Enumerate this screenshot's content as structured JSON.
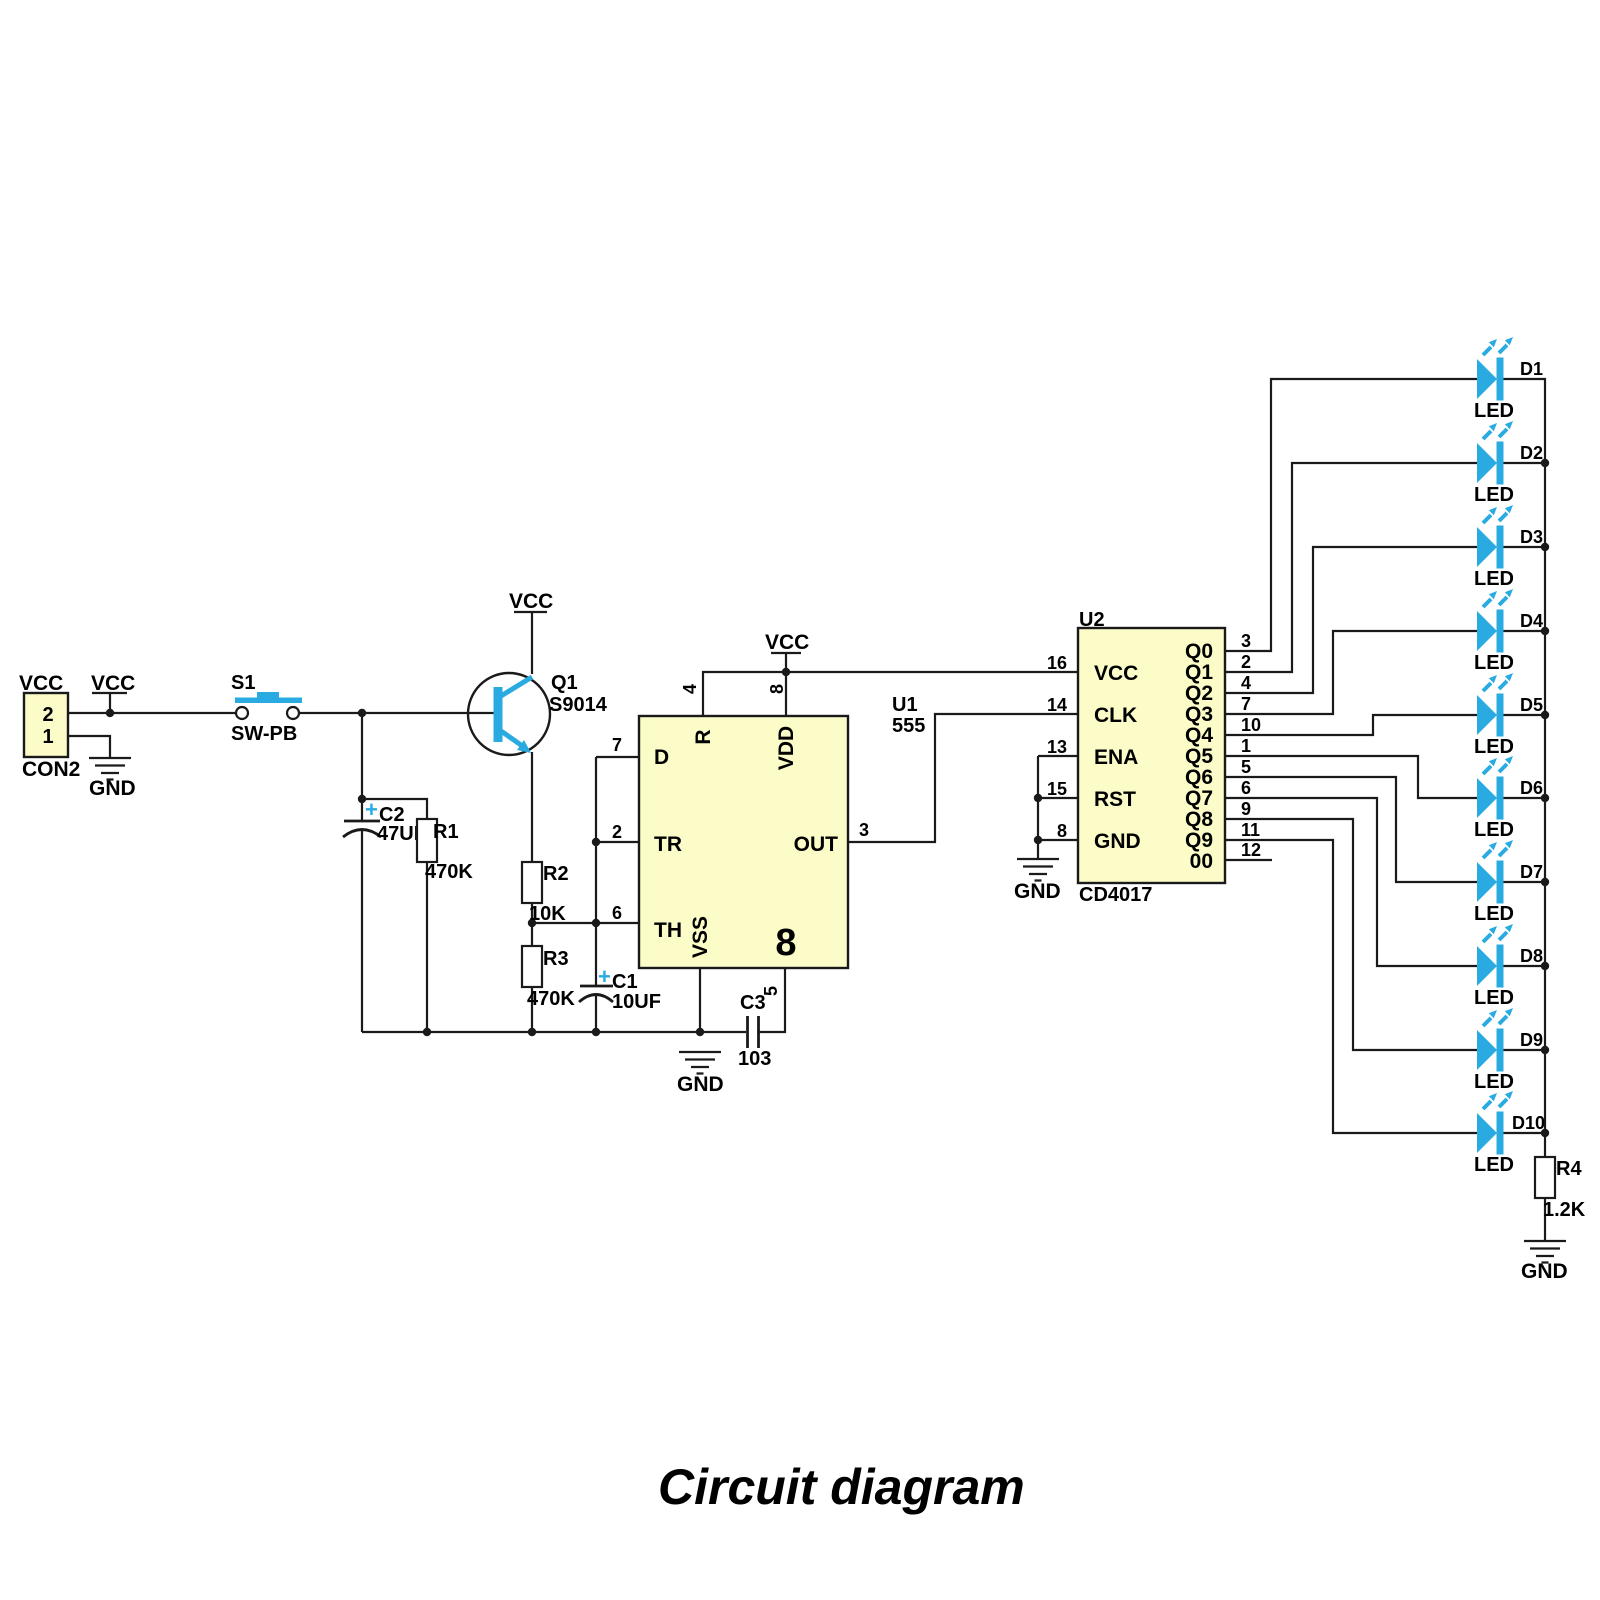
{
  "title": "Circuit diagram",
  "colors": {
    "accent": "#29ABE2",
    "ic_fill": "#FCFCC9",
    "wire": "#1A1A1A"
  },
  "power": {
    "vcc": "VCC",
    "gnd": "GND"
  },
  "con2": {
    "ref": "CON2",
    "pin_top": "2",
    "pin_bottom": "1"
  },
  "s1": {
    "ref": "S1",
    "part": "SW-PB"
  },
  "q1": {
    "ref": "Q1",
    "part": "S9014"
  },
  "r1": {
    "ref": "R1",
    "value": "470K"
  },
  "r2": {
    "ref": "R2",
    "value": "10K"
  },
  "r3": {
    "ref": "R3",
    "value": "470K"
  },
  "r4": {
    "ref": "R4",
    "value": "1.2K"
  },
  "c1": {
    "ref": "C1",
    "value": "10UF",
    "polarity": "+"
  },
  "c2": {
    "ref": "C2",
    "value": "47UF",
    "polarity": "+"
  },
  "c3": {
    "ref": "C3",
    "value": "103"
  },
  "u1": {
    "ref": "U1",
    "part": "555",
    "package": "8",
    "pin4": "4",
    "pin8": "8",
    "pin7": "7",
    "pin2": "2",
    "pin6": "6",
    "pin3": "3",
    "pin5": "5",
    "lbl_r": "R",
    "lbl_vdd": "VDD",
    "lbl_d": "D",
    "lbl_tr": "TR",
    "lbl_th": "TH",
    "lbl_vss": "VSS",
    "lbl_out": "OUT"
  },
  "u2": {
    "ref": "U2",
    "part": "CD4017",
    "left_pins": [
      {
        "num": "16",
        "name": "VCC"
      },
      {
        "num": "14",
        "name": "CLK"
      },
      {
        "num": "13",
        "name": "ENA"
      },
      {
        "num": "15",
        "name": "RST"
      },
      {
        "num": "8",
        "name": "GND"
      }
    ],
    "right_pins": [
      {
        "num": "3",
        "name": "Q0"
      },
      {
        "num": "2",
        "name": "Q1"
      },
      {
        "num": "4",
        "name": "Q2"
      },
      {
        "num": "7",
        "name": "Q3"
      },
      {
        "num": "10",
        "name": "Q4"
      },
      {
        "num": "1",
        "name": "Q5"
      },
      {
        "num": "5",
        "name": "Q6"
      },
      {
        "num": "6",
        "name": "Q7"
      },
      {
        "num": "9",
        "name": "Q8"
      },
      {
        "num": "11",
        "name": "Q9"
      },
      {
        "num": "12",
        "name": "00"
      }
    ]
  },
  "leds": [
    {
      "ref": "D1",
      "label": "LED"
    },
    {
      "ref": "D2",
      "label": "LED"
    },
    {
      "ref": "D3",
      "label": "LED"
    },
    {
      "ref": "D4",
      "label": "LED"
    },
    {
      "ref": "D5",
      "label": "LED"
    },
    {
      "ref": "D6",
      "label": "LED"
    },
    {
      "ref": "D7",
      "label": "LED"
    },
    {
      "ref": "D8",
      "label": "LED"
    },
    {
      "ref": "D9",
      "label": "LED"
    },
    {
      "ref": "D10",
      "label": "LED"
    }
  ]
}
